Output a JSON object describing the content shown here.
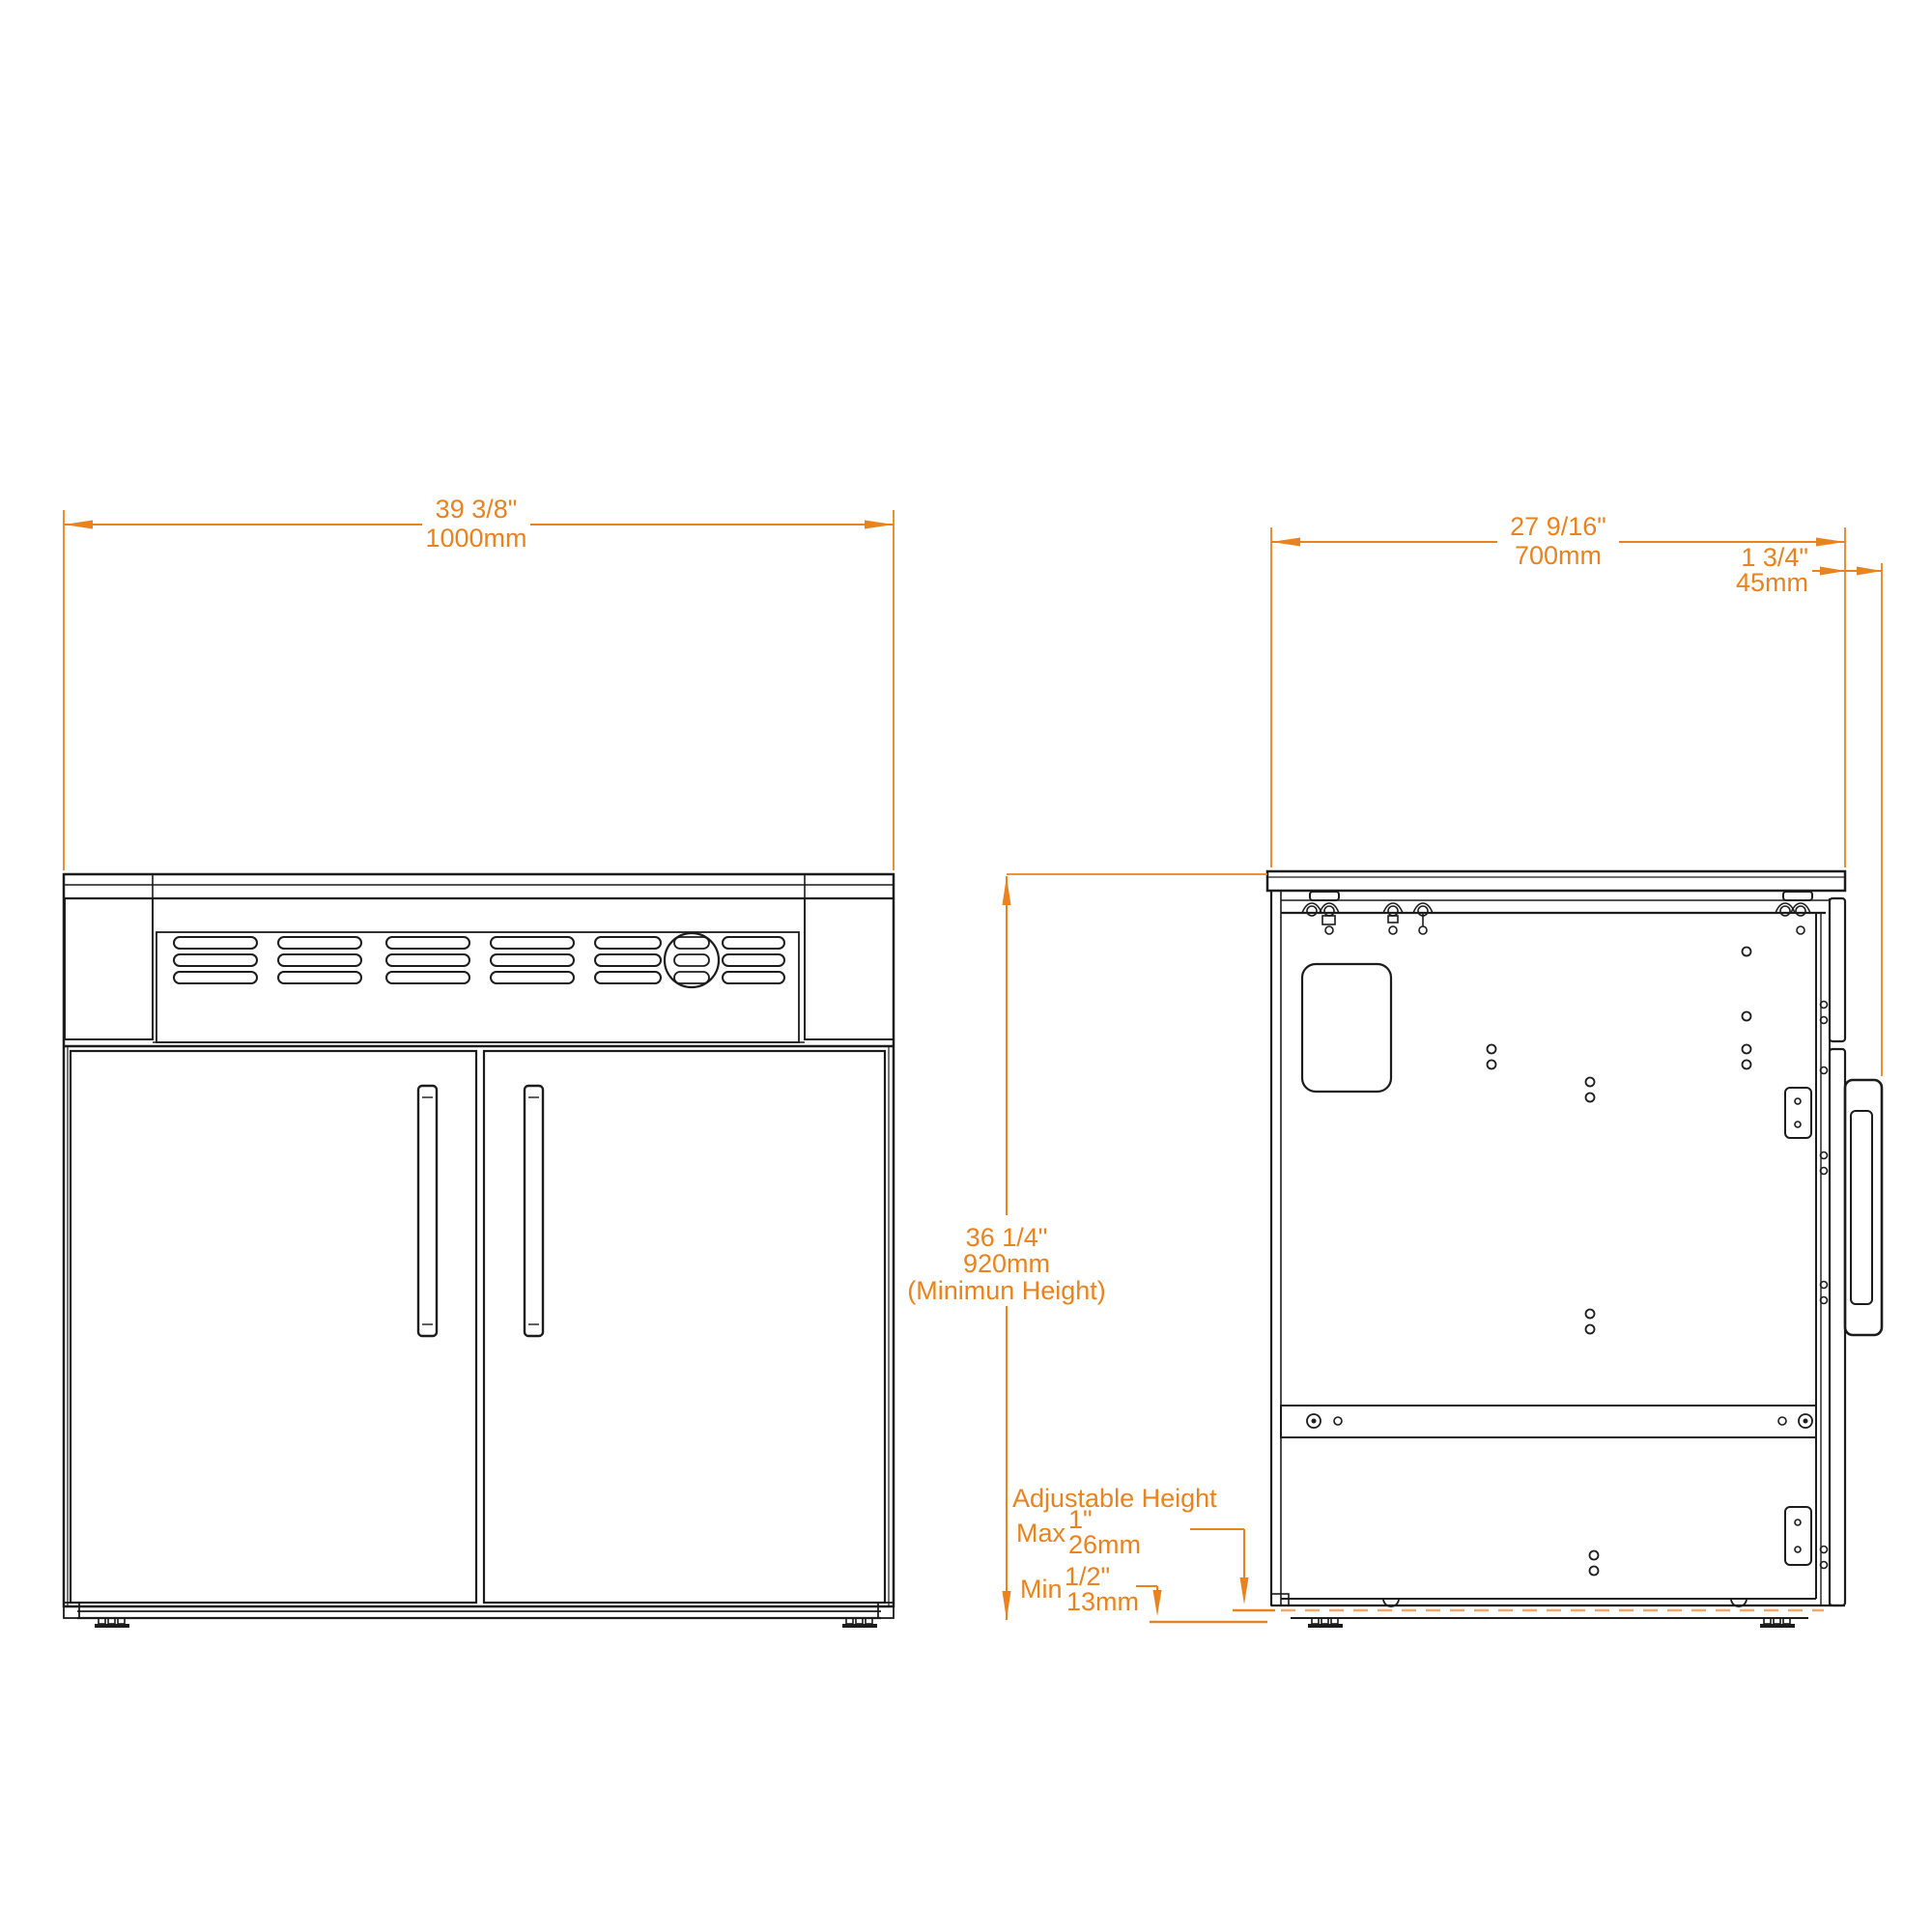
{
  "drawing": {
    "kind": "cabinet technical dimension drawing",
    "views": [
      "front",
      "side"
    ]
  },
  "colors": {
    "dimension_orange": "#E8831F",
    "dashed_orange": "#F0A86B",
    "line_ink": "#1C1C1C",
    "background": "#FFFFFF"
  },
  "front_view": {
    "width_in": "39 3/8\"",
    "width_mm": "1000mm"
  },
  "side_view": {
    "depth_in": "27 9/16\"",
    "depth_mm": "700mm",
    "door_in": "1 3/4\"",
    "door_mm": "45mm",
    "height_in": "36 1/4\"",
    "height_mm": "920mm",
    "height_note": "(Minimun Height)"
  },
  "adjustable_height": {
    "title": "Adjustable Height",
    "max_label": "Max",
    "max_in": "1\"",
    "max_mm": "26mm",
    "min_label": "Min",
    "min_in": "1/2\"",
    "min_mm": "13mm"
  }
}
